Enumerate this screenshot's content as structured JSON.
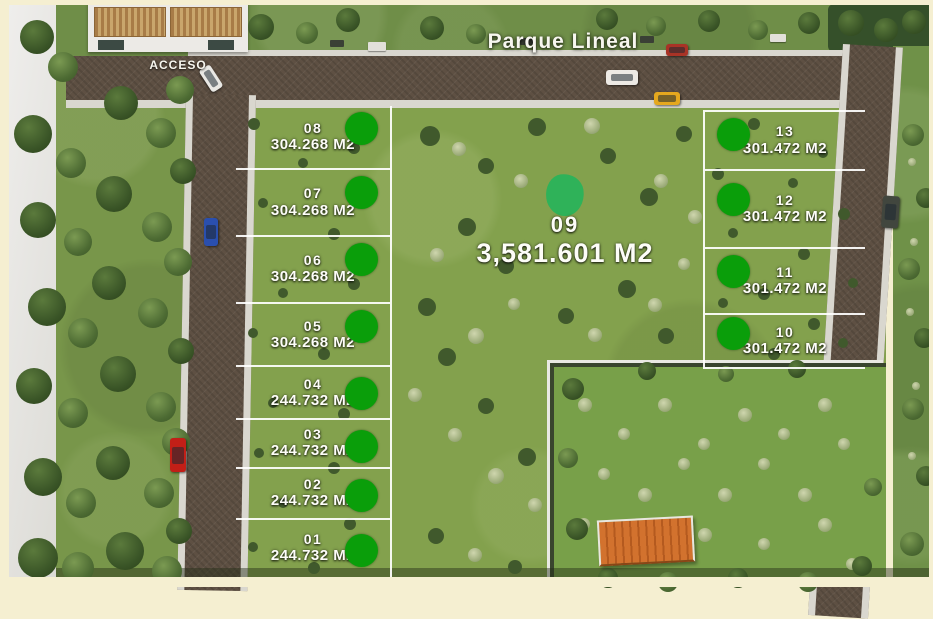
{
  "scene": {
    "park_label": "Parque Lineal",
    "access_label": "ACCESO",
    "marker_color": "#0a9e0a",
    "center_marker_color": "#2fb259",
    "vehicles": [
      "white-car",
      "blue-car",
      "red-car",
      "white-van",
      "yellow-car",
      "red-car-top",
      "gray-car"
    ]
  },
  "lots": {
    "center": {
      "id": "09",
      "area": "3,581.601 M2"
    },
    "left_column": [
      {
        "id": "08",
        "area": "304.268 M2"
      },
      {
        "id": "07",
        "area": "304.268 M2"
      },
      {
        "id": "06",
        "area": "304.268 M2"
      },
      {
        "id": "05",
        "area": "304.268 M2"
      },
      {
        "id": "04",
        "area": "244.732 M2"
      },
      {
        "id": "03",
        "area": "244.732 M2"
      },
      {
        "id": "02",
        "area": "244.732 M2"
      },
      {
        "id": "01",
        "area": "244.732 M2"
      }
    ],
    "right_column": [
      {
        "id": "13",
        "area": "301.472 M2"
      },
      {
        "id": "12",
        "area": "301.472 M2"
      },
      {
        "id": "11",
        "area": "301.472 M2"
      },
      {
        "id": "10",
        "area": "301.472 M2"
      }
    ]
  },
  "palette": {
    "grass": "#81a04c",
    "road": "#5e5043",
    "sidewalk": "#d9d7cf",
    "frame": "#f5efd1",
    "building_roof": "#d2722e"
  }
}
